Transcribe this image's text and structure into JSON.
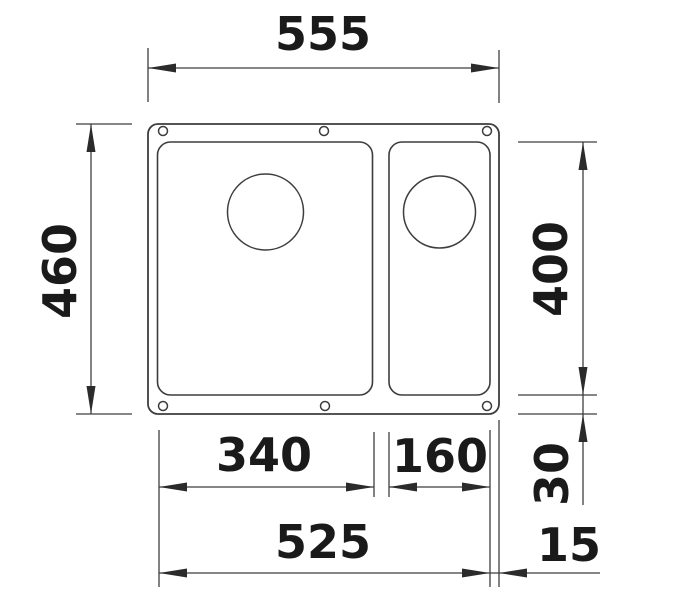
{
  "drawing": {
    "kind": "technical-dimension-drawing",
    "subject": "undermount one-and-a-half bowl sink, top view",
    "colors": {
      "line": "#3d3d3d",
      "text": "#1a1a1a",
      "background": "#ffffff"
    },
    "labels": {
      "overall_width": "555",
      "overall_depth": "460",
      "bowl_length": "400",
      "main_bowl_width": "340",
      "side_bowl_width": "160",
      "bowls_total_width": "525",
      "rear_offset": "30",
      "side_offset": "15"
    }
  }
}
